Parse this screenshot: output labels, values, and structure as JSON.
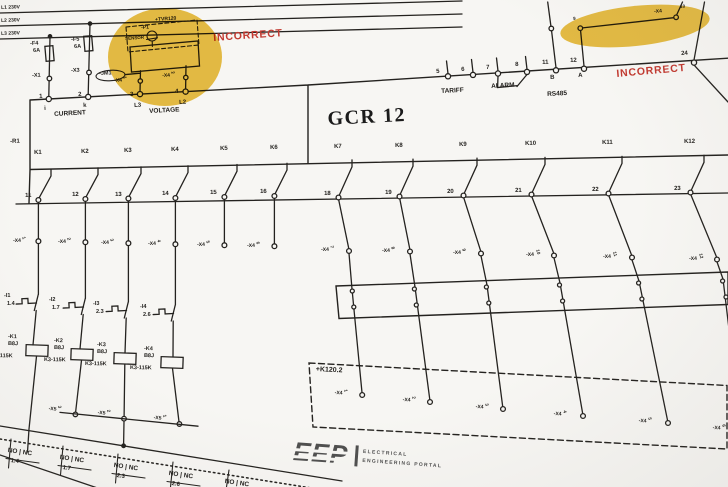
{
  "colors": {
    "highlight": "#e7b82c",
    "alert": "#c23a31",
    "ink": "#24221f",
    "logo_gray": "#4f4f4f",
    "background": "#f7f6f3"
  },
  "annotations": {
    "incorrect_left": "INCORRECT",
    "incorrect_right": "INCORRECT"
  },
  "supply_lines": [
    {
      "label": "L1 230V"
    },
    {
      "label": "L2 230V"
    },
    {
      "label": "L3 230V"
    }
  ],
  "fuses": [
    {
      "name": "-F4",
      "rating": "6A"
    },
    {
      "name": "-F5",
      "rating": "6A"
    }
  ],
  "input_terminals": [
    {
      "name": "-X1"
    },
    {
      "name": "-X3"
    }
  ],
  "tvr_block": {
    "frame_label": "+TVR120",
    "device_label": "-P1",
    "sensor_label": "SENSOR",
    "jumper_label": "-JM1",
    "x4_left": {
      "label": "-X4",
      "sup": "1"
    },
    "x4_right": {
      "label": "-X4",
      "sup": "2"
    }
  },
  "meter": {
    "title": "GCR 12",
    "current_label": "CURRENT",
    "voltage_label": "VOLTAGE",
    "tariff_label": "TARIFF",
    "alarm_label": "ALARM",
    "rs485_label": "RS485",
    "terminals": {
      "t1": "1",
      "t1_sub": "i",
      "t2": "2",
      "t2_sub": "k",
      "t3": "3",
      "t3_sub": "L3",
      "t4": "4",
      "t4_sub": "L2",
      "t5": "5",
      "t6": "6",
      "t7": "7",
      "t8": "8",
      "t11": "11",
      "t11_sub": "B",
      "t12": "12",
      "t12_sub": "A",
      "t24": "24"
    }
  },
  "bridge": {
    "label": "-X4",
    "left_sup": "9",
    "right_sup": "10"
  },
  "resistor_label": "-R1",
  "x4_strip_label": "-X4",
  "relay_contacts": [
    {
      "name": "K1",
      "terminal": "11",
      "x4_sup": "1"
    },
    {
      "name": "K2",
      "terminal": "12",
      "x4_sup": "2"
    },
    {
      "name": "K3",
      "terminal": "13",
      "x4_sup": "3"
    },
    {
      "name": "K4",
      "terminal": "14",
      "x4_sup": "4"
    },
    {
      "name": "K5",
      "terminal": "15",
      "x4_sup": "5"
    },
    {
      "name": "K6",
      "terminal": "16",
      "x4_sup": "6"
    },
    {
      "name": "K7",
      "terminal": "18",
      "x4_sup": "7"
    },
    {
      "name": "K8",
      "terminal": "19",
      "x4_sup": "8"
    },
    {
      "name": "K9",
      "terminal": "20",
      "x4_sup": "9"
    },
    {
      "name": "K10",
      "terminal": "21",
      "x4_sup": "10"
    },
    {
      "name": "K11",
      "terminal": "22",
      "x4_sup": "11"
    },
    {
      "name": "K12",
      "terminal": "23",
      "x4_sup": "12"
    }
  ],
  "aux_switches": [
    {
      "name": "-I1",
      "ref": "1.4"
    },
    {
      "name": "-I2",
      "ref": "1.7"
    },
    {
      "name": "-I3",
      "ref": "2.3"
    },
    {
      "name": "-I4",
      "ref": "2.6"
    }
  ],
  "relay_coils": [
    {
      "name": "-K1",
      "code": "B8J",
      "type": "K3-115K"
    },
    {
      "name": "-K2",
      "code": "B8J",
      "type": "K3-115K"
    },
    {
      "name": "-K3",
      "code": "B8J",
      "type": "K3-115K"
    },
    {
      "name": "-K4",
      "code": "B8J",
      "type": "K3-115K"
    }
  ],
  "x5_terminals": [
    {
      "label": "-X5",
      "sup": "3"
    },
    {
      "label": "-X5",
      "sup": "2"
    },
    {
      "label": "-X5",
      "sup": "1"
    }
  ],
  "field_enclosure": {
    "label": "+K120.2",
    "terminals": [
      {
        "label": "-X4",
        "sup": "1"
      },
      {
        "label": "-X4",
        "sup": "2"
      },
      {
        "label": "-X4",
        "sup": "3"
      },
      {
        "label": "-X4",
        "sup": "4"
      },
      {
        "label": "-X4",
        "sup": "5"
      },
      {
        "label": "-X4",
        "sup": "6"
      }
    ]
  },
  "contact_ref_tables": {
    "header": "NO | NC",
    "refs": [
      "1.4",
      "1.7",
      "2.3",
      "2.6",
      ""
    ]
  },
  "logo": {
    "acronym": "EEP",
    "tagline_line1": "ELECTRICAL",
    "tagline_line2": "ENGINEERING PORTAL"
  }
}
